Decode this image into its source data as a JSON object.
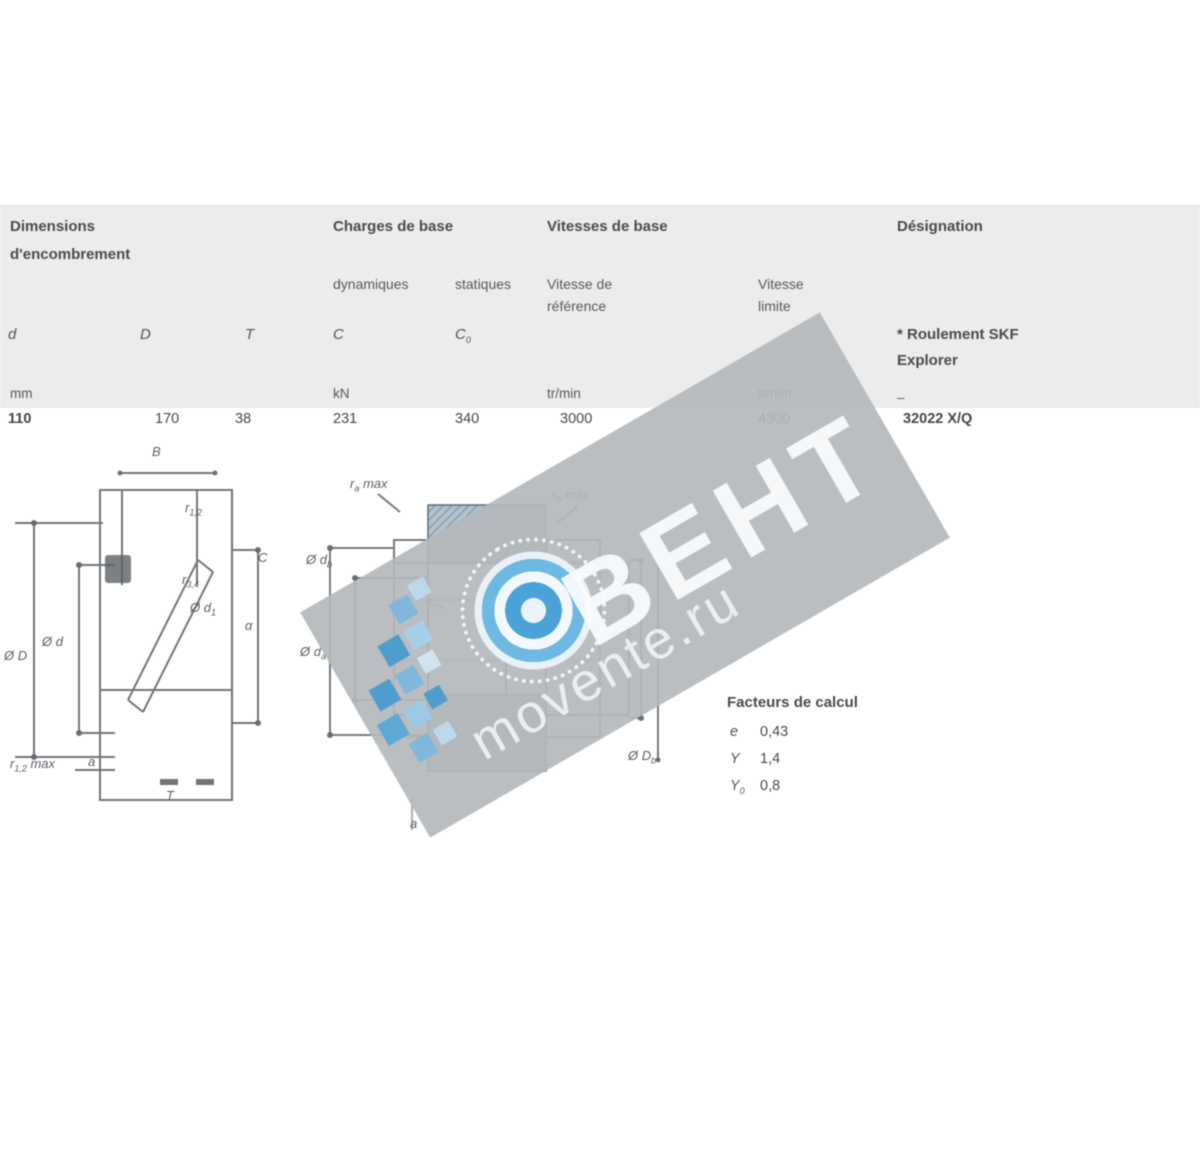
{
  "table": {
    "dims_1": "Dimensions",
    "dims_2": "d'encombrement",
    "loads": "Charges de base",
    "speeds": "Vitesses de base",
    "designation": "Désignation",
    "dyn": "dynamiques",
    "stat": "statiques",
    "ref_1": "Vitesse de",
    "ref_2": "référence",
    "lim_1": "Vitesse",
    "lim_2": "limite",
    "explorer_1": "* Roulement SKF",
    "explorer_2": "Explorer",
    "col_d": "d",
    "col_D": "D",
    "col_T": "T",
    "col_C": "C",
    "col_C0_main": "C",
    "col_C0_sub": "0",
    "unit_mm": "mm",
    "unit_kn": "kN",
    "unit_rpm_ref": "tr/min",
    "unit_rpm_lim": "tr/min",
    "unit_dash": "–",
    "row": {
      "d": "110",
      "D": "170",
      "T": "38",
      "C": "231",
      "C0": "340",
      "v_ref": "3000",
      "v_lim": "4300",
      "designation": "32022 X/Q"
    }
  },
  "figure_left": {
    "labels": [
      {
        "t": "B"
      },
      {
        "t": "r",
        "s": "1,2"
      },
      {
        "t": "r",
        "s": "3,4"
      },
      {
        "t": "Ø d",
        "s": "1"
      },
      {
        "t": "α"
      },
      {
        "t": "Ø D"
      },
      {
        "t": "Ø d"
      },
      {
        "t": "r",
        "s": "1,2",
        "x": " max"
      },
      {
        "t": "a"
      },
      {
        "t": "T"
      },
      {
        "t": "C"
      }
    ]
  },
  "figure_right": {
    "labels": [
      {
        "t": "r",
        "s": "a",
        "x": " max"
      },
      {
        "t": "r",
        "s": "b",
        "x": " max"
      },
      {
        "t": "Ø d",
        "s": "b"
      },
      {
        "t": "Ø d",
        "s": "a"
      },
      {
        "t": "Ø D",
        "s": "a"
      },
      {
        "t": "Ø D",
        "s": "b"
      },
      {
        "t": "C",
        "s": "a"
      },
      {
        "t": "C",
        "s": "b"
      },
      {
        "t": "a"
      },
      {
        "t": "a"
      }
    ]
  },
  "factors": {
    "title": "Facteurs de calcul",
    "rows": [
      {
        "sym": "e",
        "sub": "",
        "val": "0,43"
      },
      {
        "sym": "Y",
        "sub": "",
        "val": "1,4"
      },
      {
        "sym": "Y",
        "sub": "0",
        "val": "0,8"
      }
    ]
  },
  "watermark": {
    "brand": "ВЕНТ",
    "site": "movente.ru"
  },
  "colors": {
    "band": "#b4b8bb",
    "logo_blue": "#4aa3d8",
    "header_bg": "#ececec"
  }
}
